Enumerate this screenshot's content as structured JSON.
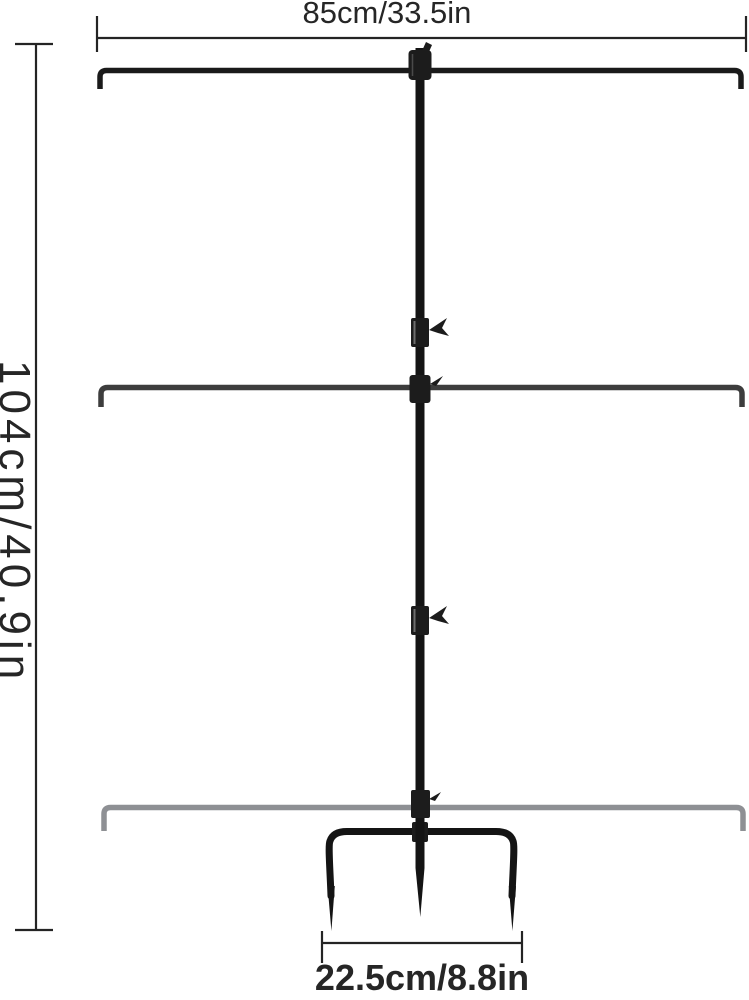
{
  "diagram": {
    "description": "Three-tier adjustable garden pole stand with ground stake, dimension diagram",
    "dimensions": {
      "width": {
        "label": "85cm/33.5in"
      },
      "height": {
        "label": "104cm/40.9in"
      },
      "stake_width": {
        "label": "22.5cm/8.8in"
      }
    },
    "colors": {
      "background": "#ffffff",
      "annotation": "#242424",
      "tier_top": "#1a1a1a",
      "tier_middle": "#3d3d3d",
      "tier_bottom": "#8e9094",
      "pole": "#141414",
      "hardware": "#1c1c1c",
      "sleeve_highlight": "#6e6e6e",
      "stake": "#141414"
    }
  }
}
